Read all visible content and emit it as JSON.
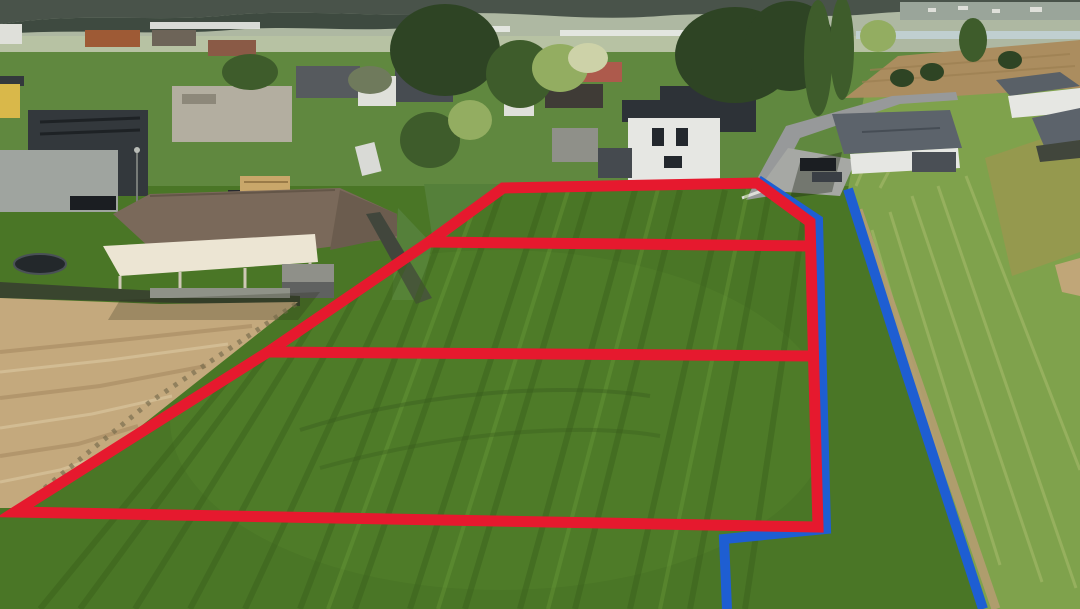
{
  "meta": {
    "title": "Aerial drone photo of building plots for sale",
    "type": "aerial-photo",
    "width": 1080,
    "height": 609
  },
  "scene": {
    "description": "Drone aerial view of a green meadow on a village edge. Three adjacent building plots are outlined and divided with thick red marker lines; two blue marker lines trace boundaries/access strips to the right of the plots. Houses, gardens and a road lie in the upper part; a sandy tilled field lies to the lower left; a lighter mowed slope with a dirt track lies to the right; hazy hills, greenhouses and a distant village line the horizon.",
    "regions": {
      "plots": "three red-outlined grass parcels",
      "sand_field": "bare sandy field lower left",
      "village": "residential houses upper band",
      "hillside": "light green mowed slope right",
      "plowed_field": "brown plowed field top right",
      "horizon": "hazy hills and valley with greenhouses"
    }
  },
  "palette": {
    "field_green": "#4a7626",
    "hillside_green": "#7fa24c",
    "sand": "#c4a97d",
    "plowed_field": "#ab8d5f",
    "valley": "#aeb8a2",
    "mountains": "#49534a",
    "road_gray": "#97999a",
    "roof_brown": "#7a695a",
    "canopy_cream": "#ece5d3",
    "marker_red": "#e6192e",
    "marker_blue": "#1e5ed2",
    "track_tan": "#b59c71"
  },
  "overlays": {
    "red_boundary": {
      "label": "red outer plot boundary",
      "points": "503,188 757,183 810,222 818,527 15,512 268,352 429,242",
      "width": 11
    },
    "red_divider_upper": {
      "label": "red divider between plot 1 and 2",
      "points": "429,242 812,246",
      "width": 11
    },
    "red_divider_lower": {
      "label": "red divider between plot 2 and 3",
      "points": "268,352 816,356",
      "width": 11
    },
    "blue_left": {
      "label": "blue boundary line along right edge of plots",
      "points": "758,180 818,220 826,529 724,539 727,609",
      "width": 10
    },
    "blue_right": {
      "label": "blue boundary line along dirt track",
      "points": "848,189 906,372 983,609",
      "width": 10
    }
  }
}
